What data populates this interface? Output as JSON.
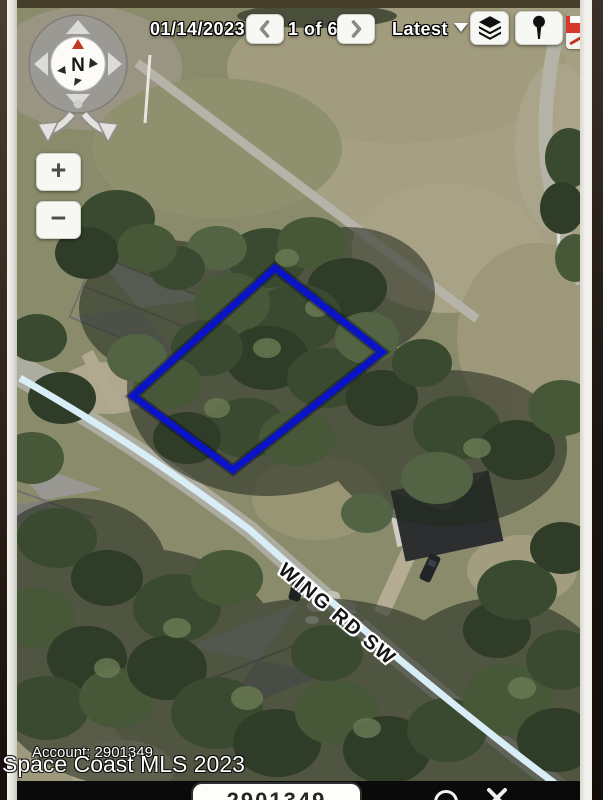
{
  "toolbar": {
    "date": "01/14/2023",
    "page_indicator": "1 of 6",
    "latest_label": "Latest"
  },
  "compass": {
    "north_label": "N"
  },
  "zoom_controls": {
    "zoom_in_glyph": "+",
    "zoom_out_glyph": "−"
  },
  "map": {
    "road_label": "WING RD SW",
    "colors": {
      "parcel_outline": "#0b13c7",
      "road_highlight": "#d9edf6",
      "toolbar_button": "#f7f7f4"
    }
  },
  "watermark": {
    "account_line": "Account: 2901349",
    "mls_line": "Space Coast MLS 2023"
  },
  "bottom_bar": {
    "account_value": "2901349"
  }
}
